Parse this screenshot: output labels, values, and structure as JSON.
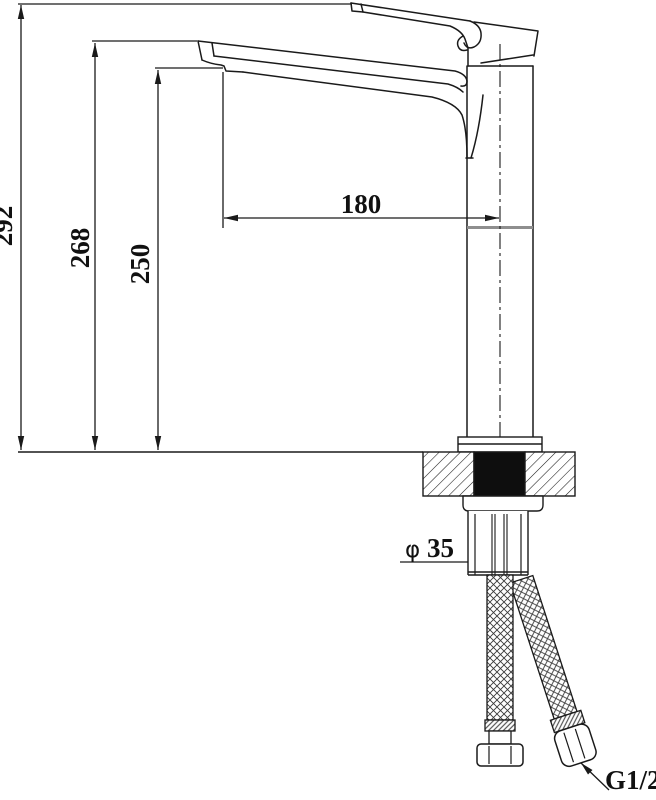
{
  "drawing": {
    "labels": {
      "overall_height": "292",
      "spout_top_height": "268",
      "outlet_height": "250",
      "spout_reach": "180",
      "diameter_symbol": "φ",
      "diameter_value": "35",
      "thread_size": "G1/2"
    },
    "colors": {
      "line": "#1a1a1a",
      "background": "#ffffff",
      "section_fill": "#0e0e0e",
      "joint_line": "#8e8e8e"
    }
  }
}
